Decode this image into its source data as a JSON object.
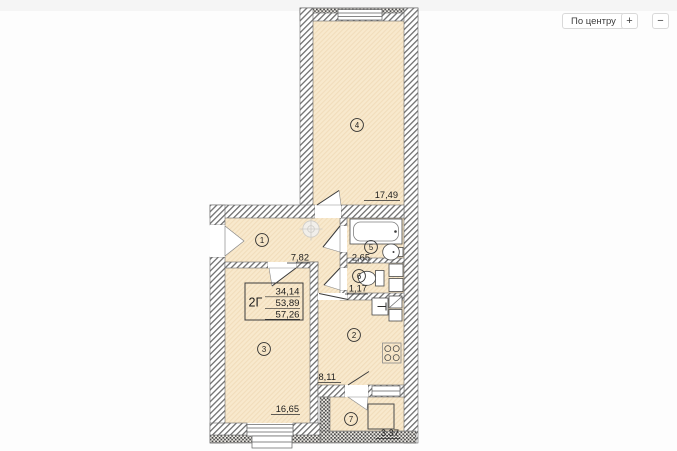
{
  "controls": {
    "center_label": "По центру",
    "zoom_in_label": "+",
    "zoom_out_label": "−"
  },
  "plan": {
    "apartment": {
      "type": "2Г",
      "areas": [
        "34,14",
        "53,89",
        "57,26"
      ]
    },
    "rooms": [
      {
        "number": "1",
        "area": "7,82"
      },
      {
        "number": "2",
        "area": "8,11"
      },
      {
        "number": "3",
        "area": "16,65"
      },
      {
        "number": "4",
        "area": "17,49"
      },
      {
        "number": "5",
        "area": "2,65"
      },
      {
        "number": "6",
        "area": "1,17"
      },
      {
        "number": "7",
        "area": "3,37"
      }
    ],
    "colors": {
      "room_fill": "#f8e9cd",
      "wall_hatch": "#707070",
      "text": "#1d1d1d"
    }
  }
}
